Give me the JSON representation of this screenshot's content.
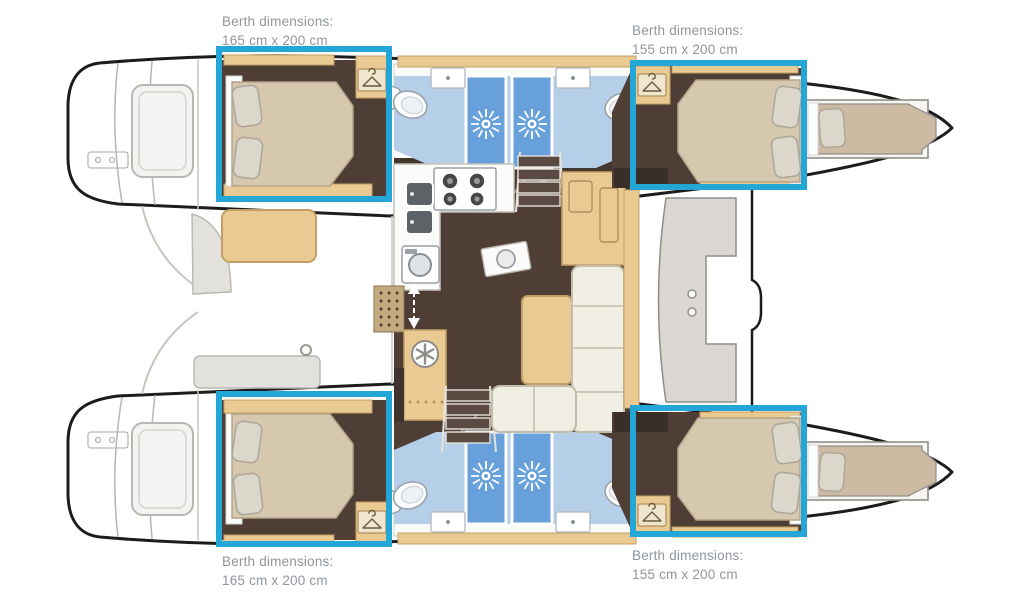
{
  "page": {
    "background": "#ffffff",
    "description": "Catamaran yacht deck plan with four highlighted double berths"
  },
  "colors": {
    "highlight": "#24a7d7",
    "label_text": "#8f969c",
    "cabin_floor": "#4f3e35",
    "wood": "#e9ca92",
    "bathroom_floor": "#b6cfe9",
    "shower_blue": "#67a0da",
    "bed": "#d6c7af"
  },
  "annotations": {
    "top_left": {
      "label": "Berth dimensions:",
      "size": "165 cm x 200 cm"
    },
    "top_right": {
      "label": "Berth dimensions:",
      "size": "155 cm x 200 cm"
    },
    "bottom_left": {
      "label": "Berth dimensions:",
      "size": "165 cm x 200 cm"
    },
    "bottom_right": {
      "label": "Berth dimensions:",
      "size": "155 cm x 200 cm"
    }
  },
  "icons": [
    "hanger-icon",
    "shower-sun-icon",
    "fan-icon",
    "stove-icon",
    "toilet-icon",
    "sink-icon",
    "stairs-arrow-icon"
  ]
}
